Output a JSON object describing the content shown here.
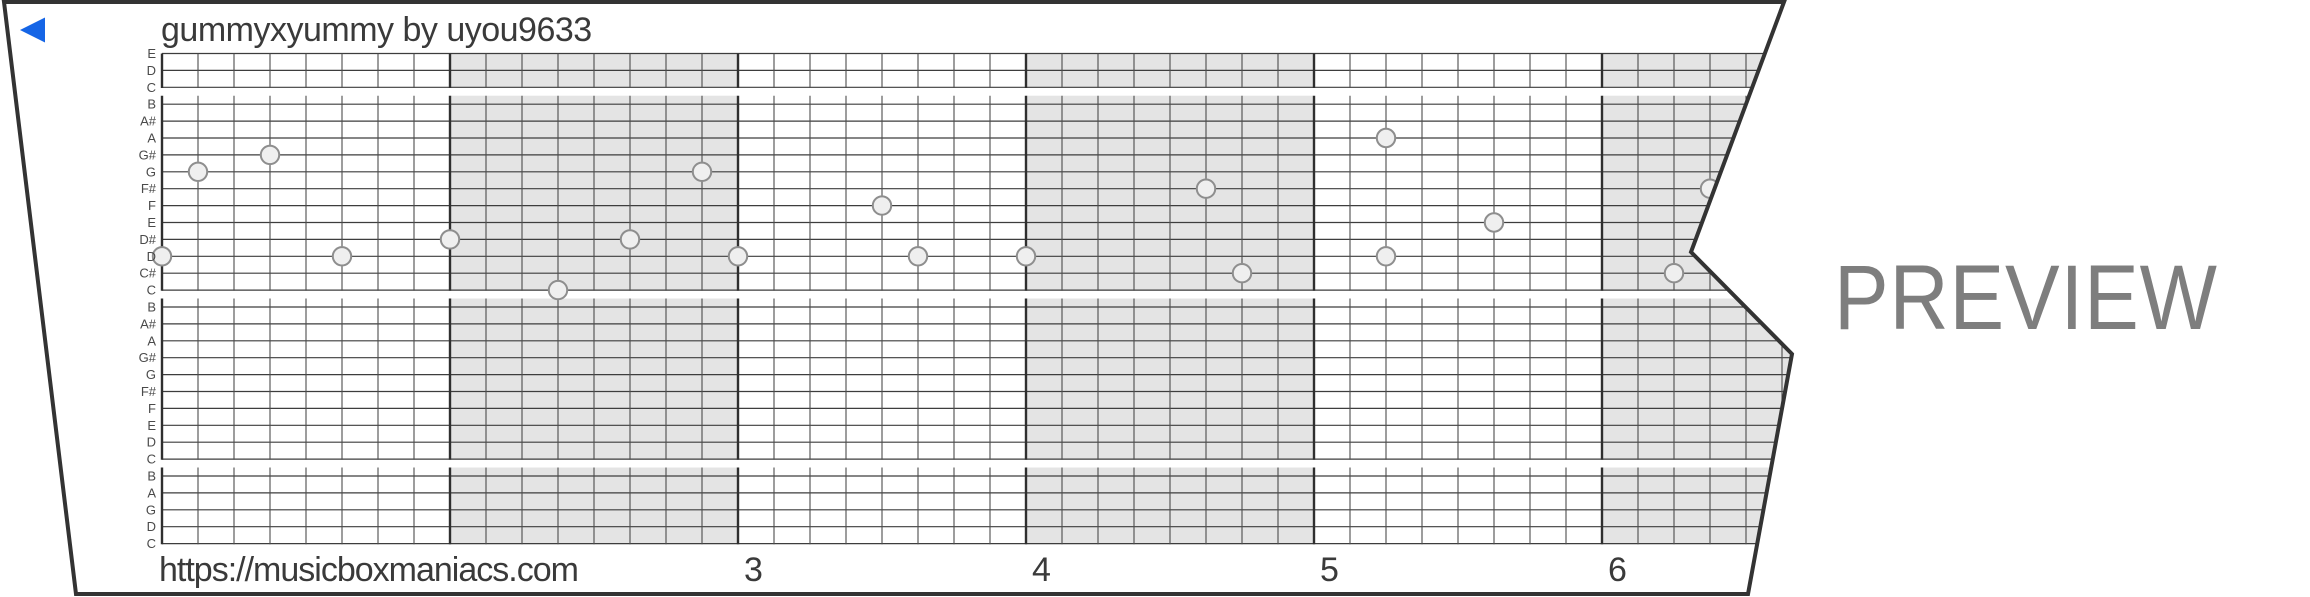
{
  "header": {
    "title": "gummyxyummy by uyou9633"
  },
  "player": {
    "back_icon_color": "#1565e6"
  },
  "watermark": {
    "label": "PREVIEW",
    "color": "#7e7e7e"
  },
  "footer": {
    "url": "https://musicboxmaniacs.com",
    "measure_numbers": [
      "3",
      "4",
      "5",
      "6"
    ]
  },
  "strip": {
    "note_labels": [
      "E",
      "D",
      "C",
      "B",
      "A#",
      "A",
      "G#",
      "G",
      "F#",
      "F",
      "E",
      "D#",
      "D",
      "C#",
      "C",
      "B",
      "A#",
      "A",
      "G#",
      "G",
      "F#",
      "F",
      "E",
      "D",
      "C",
      "B",
      "A",
      "G",
      "D",
      "C"
    ],
    "octave_break_rows": [
      2,
      14,
      24
    ],
    "shaded_measures": [
      2,
      4,
      6
    ],
    "colors": {
      "band": "#e4e4e4",
      "hline": "#3d3d3d",
      "minor_vline": "#4d4d4d",
      "barline": "#2f2f2f",
      "border": "#333333",
      "note_fill": "#efefef",
      "note_stroke": "#8e8e8e",
      "label_text": "#4a4a4a"
    },
    "notes": [
      {
        "eighth": 0,
        "row": 12,
        "pitch": "D5"
      },
      {
        "eighth": 1,
        "row": 7,
        "pitch": "G5"
      },
      {
        "eighth": 3,
        "row": 6,
        "pitch": "G#5"
      },
      {
        "eighth": 5,
        "row": 12,
        "pitch": "D5"
      },
      {
        "eighth": 8,
        "row": 11,
        "pitch": "D#5"
      },
      {
        "eighth": 11,
        "row": 14,
        "pitch": "C5"
      },
      {
        "eighth": 13,
        "row": 11,
        "pitch": "D#5"
      },
      {
        "eighth": 15,
        "row": 7,
        "pitch": "G5"
      },
      {
        "eighth": 16,
        "row": 12,
        "pitch": "D5"
      },
      {
        "eighth": 20,
        "row": 9,
        "pitch": "F5"
      },
      {
        "eighth": 21,
        "row": 12,
        "pitch": "D5"
      },
      {
        "eighth": 24,
        "row": 12,
        "pitch": "D5"
      },
      {
        "eighth": 29,
        "row": 8,
        "pitch": "F#5"
      },
      {
        "eighth": 30,
        "row": 13,
        "pitch": "C#5"
      },
      {
        "eighth": 34,
        "row": 5,
        "pitch": "A5"
      },
      {
        "eighth": 34,
        "row": 12,
        "pitch": "D5"
      },
      {
        "eighth": 37,
        "row": 10,
        "pitch": "E5"
      },
      {
        "eighth": 42,
        "row": 13,
        "pitch": "C#5"
      },
      {
        "eighth": 43,
        "row": 8,
        "pitch": "F#5"
      }
    ]
  }
}
